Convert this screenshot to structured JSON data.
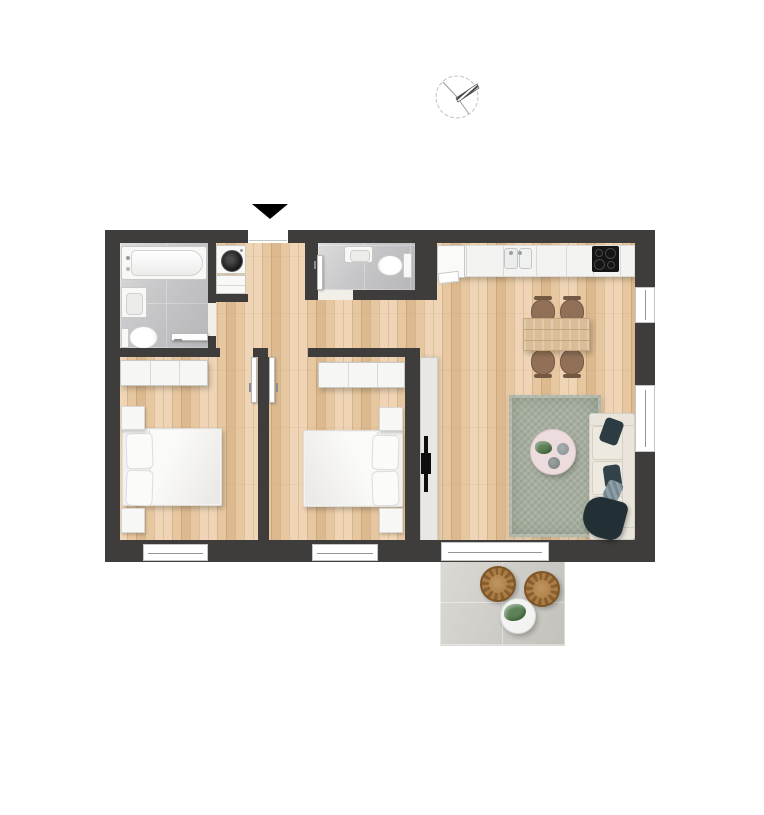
{
  "image_type": "architectural-floor-plan-top-down-no-text",
  "palette": {
    "wall": "#3e3d3c",
    "wood_1": "#efd5b5",
    "wood_2": "#e6c7a0",
    "wood_3": "#dcb98e",
    "tile": "#c7c7c9",
    "fixture_white": "#f8f8f7",
    "fixture_border": "#c9c9c6",
    "counter": "#f3f3f1",
    "counter_seam": "#d9d9d5",
    "cooktop": "#151515",
    "burner_ring": "#474747",
    "table_wood": "#d9bd97",
    "table_grain": "#c2a278",
    "chair_brown": "#927057",
    "chair_dark": "#735844",
    "rug": "#a6af9f",
    "coffee_table": "#ecdcdd",
    "deco_gray": "#879090",
    "sofa_base": "#e9e5db",
    "sofa_border": "#d5d1c4",
    "cushion": "#eee9df",
    "pillow_dark": "#2d3c43",
    "pillow_gray": "#8da0a8",
    "throw": "#222f35",
    "console": "#e9e7e3",
    "console_border": "#ceccc7",
    "tv_black": "#0e0e0e",
    "terrace_floor": "#cbc9c3",
    "rattan_1": "#aa7d45",
    "rattan_2": "#8a5f2f",
    "plant_green": "#5d8257",
    "window_frame": "#c6c6c4",
    "window_line": "#90969c",
    "leaf_white": "#fdfdfd",
    "threshold": "#f2efe9",
    "drum_black": "#1b1b1b"
  },
  "plan": {
    "compass": "north-indicator-circle-with-hatched-needle-pointing-upper-right",
    "entrance": "black-arrow-pointing-down-at-top-wall-opening",
    "rooms": [
      {
        "name": "bathroom",
        "position": "top-left",
        "floor": "gray-tile",
        "fixtures": [
          "bathtub",
          "vanity-sink",
          "toilet",
          "open-door-leaf"
        ]
      },
      {
        "name": "laundry-niche",
        "position": "top-center-left",
        "fixtures": [
          "washing-machine",
          "base-cabinet"
        ]
      },
      {
        "name": "wc",
        "position": "top-center",
        "floor": "gray-tile",
        "fixtures": [
          "wash-basin",
          "toilet",
          "open-door-leaf"
        ]
      },
      {
        "name": "entrance-hallway",
        "position": "center",
        "floor": "oak-planks"
      },
      {
        "name": "bedroom-1",
        "position": "bottom-left",
        "floor": "oak-planks",
        "fixtures": [
          "wardrobe-3-door",
          "double-bed-2-pillows",
          "nightstand",
          "nightstand",
          "open-door-leaf"
        ]
      },
      {
        "name": "bedroom-2",
        "position": "bottom-center",
        "floor": "oak-planks",
        "fixtures": [
          "wardrobe-3-door",
          "double-bed-2-pillows",
          "nightstand",
          "nightstand",
          "open-door-leaf"
        ]
      },
      {
        "name": "kitchen-living-room",
        "position": "right",
        "floor": "oak-planks",
        "fixtures": [
          "kitchen-counter-run",
          "fridge",
          "double-bowl-sink",
          "cooktop-4-burners",
          "dining-table",
          "four-chairs",
          "area-rug",
          "round-coffee-table-with-plant",
          "three-seat-sofa",
          "dark-cushions",
          "throw-blanket",
          "tv-sideboard",
          "wall-mounted-tv"
        ]
      },
      {
        "name": "terrace",
        "position": "bottom-right-outside",
        "floor": "stone-tile",
        "fixtures": [
          "rattan-chair",
          "rattan-chair",
          "round-side-table",
          "potted-plant"
        ]
      }
    ],
    "openings": {
      "entrance_door": 1,
      "right_wall_windows": 2,
      "bottom_wall_windows": 2,
      "terrace_sliding_door": 1,
      "interior_door_leaves": 4
    }
  }
}
